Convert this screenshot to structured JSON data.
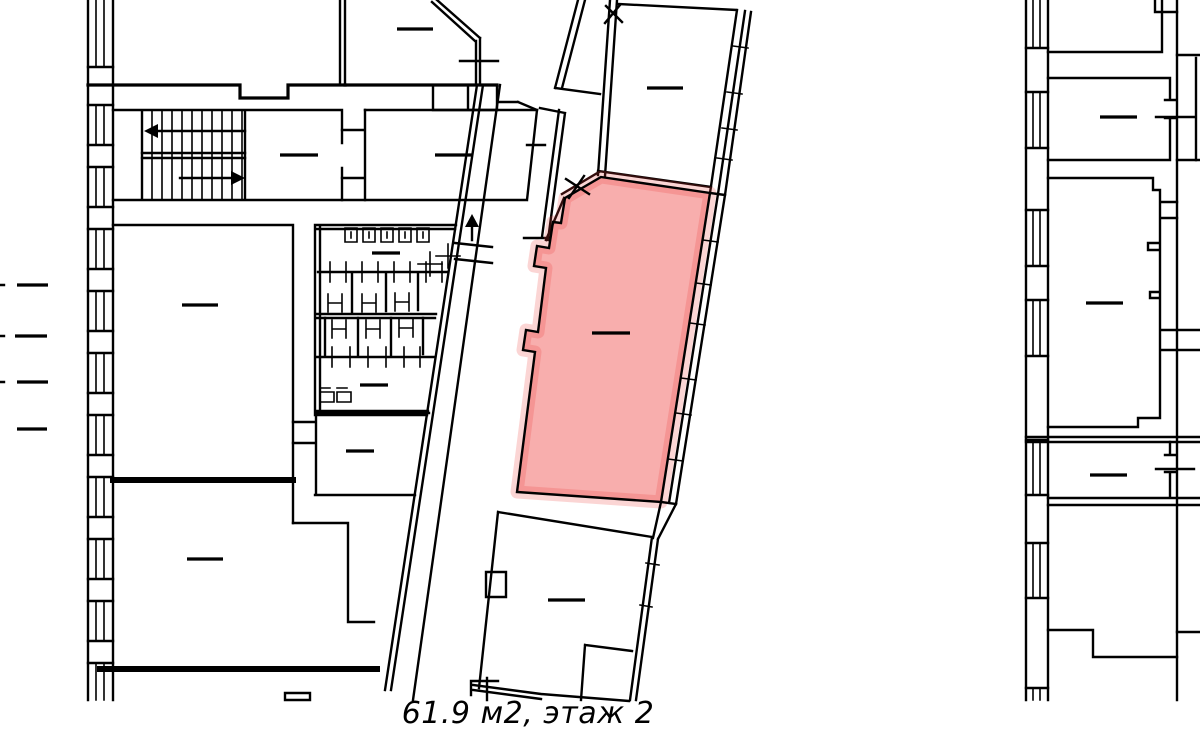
{
  "window": {
    "width": 1200,
    "height": 745,
    "background": "#ffffff"
  },
  "caption": {
    "text": "61.9 м2, этаж 2"
  },
  "colors": {
    "walls": "#000000",
    "highlight": "#ee3f3b"
  }
}
